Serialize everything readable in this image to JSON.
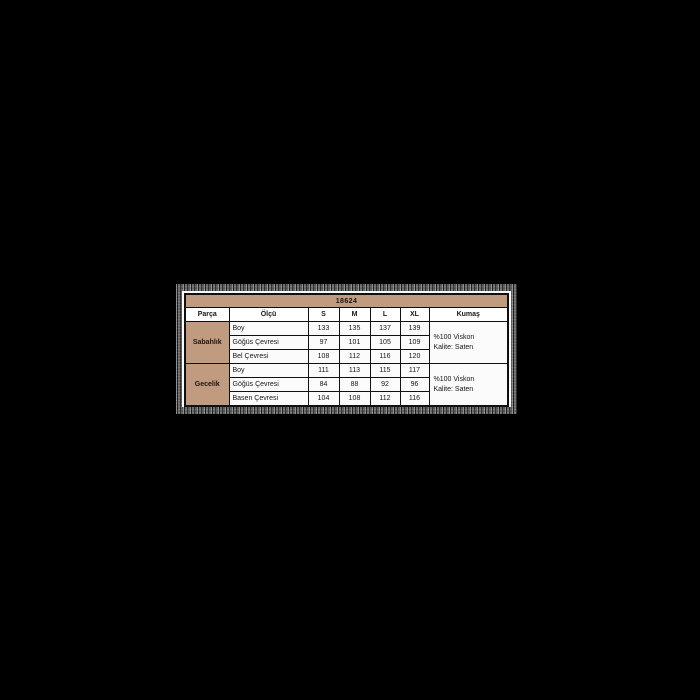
{
  "page": {
    "background_color": "#000000",
    "card_background": "#fbfbfb",
    "accent_tan": "#c19b7f",
    "border_color": "#101010"
  },
  "table": {
    "title": "18624",
    "headers": [
      "Parça",
      "Ölçü",
      "S",
      "M",
      "L",
      "XL",
      "Kumaş"
    ],
    "groups": [
      {
        "name": "Sabahlık",
        "rows": [
          {
            "label": "Boy",
            "values": [
              "133",
              "135",
              "137",
              "139"
            ]
          },
          {
            "label": "Göğüs Çevresi",
            "values": [
              "97",
              "101",
              "105",
              "109"
            ]
          },
          {
            "label": "Bel Çevresi",
            "values": [
              "108",
              "112",
              "116",
              "120"
            ]
          }
        ],
        "fabric": [
          "%100 Viskon",
          "Kalite: Saten"
        ]
      },
      {
        "name": "Gecelik",
        "rows": [
          {
            "label": "Boy",
            "values": [
              "111",
              "113",
              "115",
              "117"
            ]
          },
          {
            "label": "Göğüs Çevresi",
            "values": [
              "84",
              "88",
              "92",
              "96"
            ]
          },
          {
            "label": "Basen Çevresi",
            "values": [
              "104",
              "108",
              "112",
              "116"
            ]
          }
        ],
        "fabric": [
          "%100 Viskon",
          "Kalite: Saten"
        ]
      }
    ]
  },
  "chart_data": {
    "type": "table",
    "title": "18624",
    "columns": [
      "Parça",
      "Ölçü",
      "S",
      "M",
      "L",
      "XL",
      "Kumaş"
    ],
    "rows": [
      [
        "Sabahlık",
        "Boy",
        133,
        135,
        137,
        139,
        "%100 Viskon Kalite: Saten"
      ],
      [
        "Sabahlık",
        "Göğüs Çevresi",
        97,
        101,
        105,
        109,
        "%100 Viskon Kalite: Saten"
      ],
      [
        "Sabahlık",
        "Bel Çevresi",
        108,
        112,
        116,
        120,
        "%100 Viskon Kalite: Saten"
      ],
      [
        "Gecelik",
        "Boy",
        111,
        113,
        115,
        117,
        "%100 Viskon Kalite: Saten"
      ],
      [
        "Gecelik",
        "Göğüs Çevresi",
        84,
        88,
        92,
        96,
        "%100 Viskon Kalite: Saten"
      ],
      [
        "Gecelik",
        "Basen Çevresi",
        104,
        108,
        112,
        116,
        "%100 Viskon Kalite: Saten"
      ]
    ],
    "notes": "Size chart table on black background; tan header accents; fabric column spans 3 rows per garment group"
  }
}
